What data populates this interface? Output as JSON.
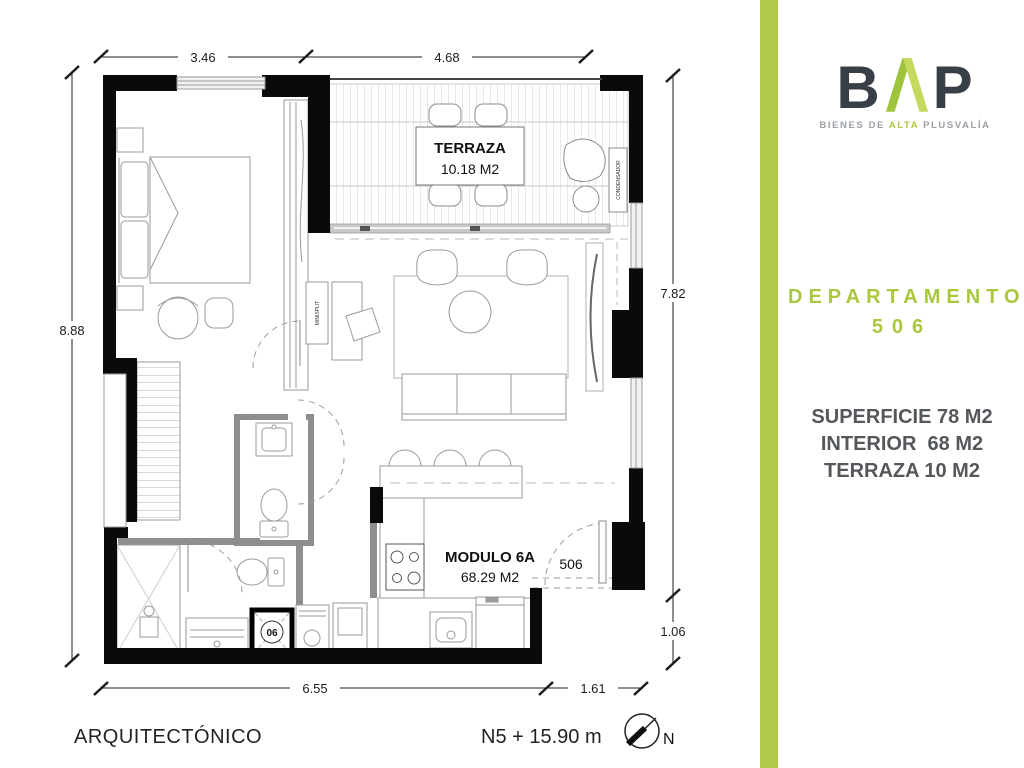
{
  "brand": {
    "letter_b": "B",
    "letter_p": "P",
    "tagline_pre": "BIENES DE ",
    "tagline_accent": "ALTA",
    "tagline_post": " PLUSVALÍA"
  },
  "unit": {
    "title": "DEPARTAMENTO",
    "number": "506",
    "stats": [
      "SUPERFICIE 78 M2",
      "INTERIOR  68 M2",
      "TERRAZA 10 M2"
    ]
  },
  "plan": {
    "labels": {
      "terraza": "TERRAZA",
      "terraza_area": "10.18 M2",
      "module": "MODULO 6A",
      "module_area": "68.29 M2",
      "unit_number": "506",
      "condenser": "CONDENSADOR",
      "minisplit": "MINISPLIT",
      "shaft": "06"
    },
    "dims": {
      "top_left": "3.46",
      "top_right": "4.68",
      "left": "8.88",
      "right_upper": "7.82",
      "right_lower": "1.06",
      "bottom_left": "6.55",
      "bottom_right": "1.61"
    },
    "footer": {
      "sheet": "ARQUITECTÓNICO",
      "level": "N5 + 15.90 m",
      "north": "N"
    }
  },
  "colors": {
    "accent_green": "#b1ca4b",
    "logo_green_left": "#9dc43b",
    "logo_green_right": "#c3da5f",
    "dark_text": "#383f46"
  }
}
